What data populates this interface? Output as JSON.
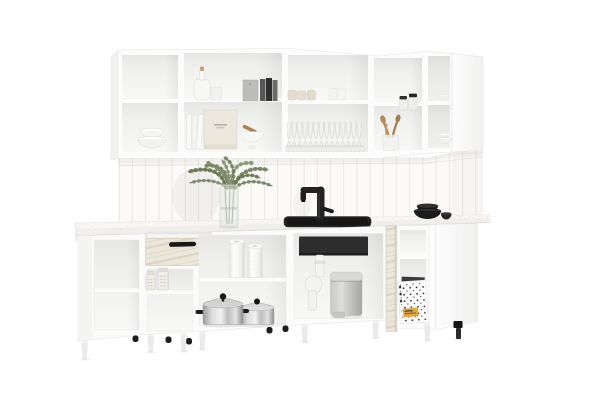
{
  "meta": {
    "kind": "product-photo-render",
    "subject": "L-shaped white modular kitchen set with open shelving, front view on white background",
    "canvas": {
      "width": 600,
      "height": 400
    },
    "background": "#ffffff"
  },
  "palette": {
    "cabinet_white": "#fbfbfb",
    "cabinet_edge": "#e6e6e6",
    "interior_shadow": "#e7e7e7",
    "tile": "#fbfaf8",
    "tile_grout": "#e9e7e3",
    "countertop": "#f6f5f2",
    "marble_laminate": "#ece7db",
    "black_fixture": "#1f1f1f",
    "stainless_steel": "#c9c9c9",
    "bin_gray": "#bdbdbd",
    "plant_green": "#74825f",
    "wood": "#b28a58",
    "label_orange": "#e4a33b"
  },
  "scene": {
    "wall_cabinets": {
      "style": "open white box shelves, two tiers, corner return on right",
      "sections": [
        {
          "id": "left",
          "contents_top": [],
          "contents_bottom": [
            "stacked white bowls"
          ]
        },
        {
          "id": "second",
          "contents_top": [
            "glass bottle with cork",
            "drinking glass",
            "gray cutting board",
            "dark books"
          ],
          "contents_bottom": [
            "white books",
            "beige box with printed label",
            "white mortar with wooden pestle"
          ]
        },
        {
          "id": "third",
          "contents_top": [
            "beige cups",
            "white cups"
          ],
          "contents_bottom": [
            "plate rack with white plates"
          ]
        },
        {
          "id": "fourth",
          "contents_top": [
            "two glass jars with black lids"
          ],
          "contents_bottom": [
            "glass vase with wooden spoons"
          ]
        },
        {
          "id": "corner",
          "contents_top": [
            "small white bowl"
          ],
          "contents_bottom": [
            "stacked white bowls"
          ],
          "note": "angled corner unit with white side gable"
        }
      ]
    },
    "backsplash": {
      "type": "vertical stacked tile",
      "tile_color": "#fbfaf8",
      "grout_color": "#e9e7e3"
    },
    "countertop": {
      "color": "#f6f5f2",
      "items": [
        "green sprigs in glass vase",
        "black single-lever faucet",
        "black drop-in sink",
        "two stacked black bowls",
        "small black bowl"
      ]
    },
    "base_cabinets": {
      "style": "open white carcasses on legs, no doors",
      "sections": [
        {
          "id": "left-end",
          "contents": [
            "empty shelves"
          ]
        },
        {
          "id": "drawer-unit",
          "drawer": {
            "state": "open",
            "front": "light marble laminate",
            "handle": "black bar"
          },
          "contents": [
            "two glass spice jars"
          ]
        },
        {
          "id": "open-shelf-unit",
          "contents": [
            "two paper towel rolls",
            "two stainless steel pots with lids and black handles"
          ]
        },
        {
          "id": "sink-unit",
          "contents": [
            "black sink bowl underside",
            "white drain trap pipe",
            "gray pedal trash bin"
          ]
        },
        {
          "id": "corner-shelf",
          "contents": [
            "white box with black dot print and orange label",
            "dark folder"
          ],
          "divider": "marble laminate post"
        },
        {
          "id": "right-end",
          "contents": [],
          "note": "white side gable faces viewer, black foot"
        }
      ],
      "legs": {
        "front": "white tapered legs",
        "rear": "black round feet"
      }
    }
  }
}
